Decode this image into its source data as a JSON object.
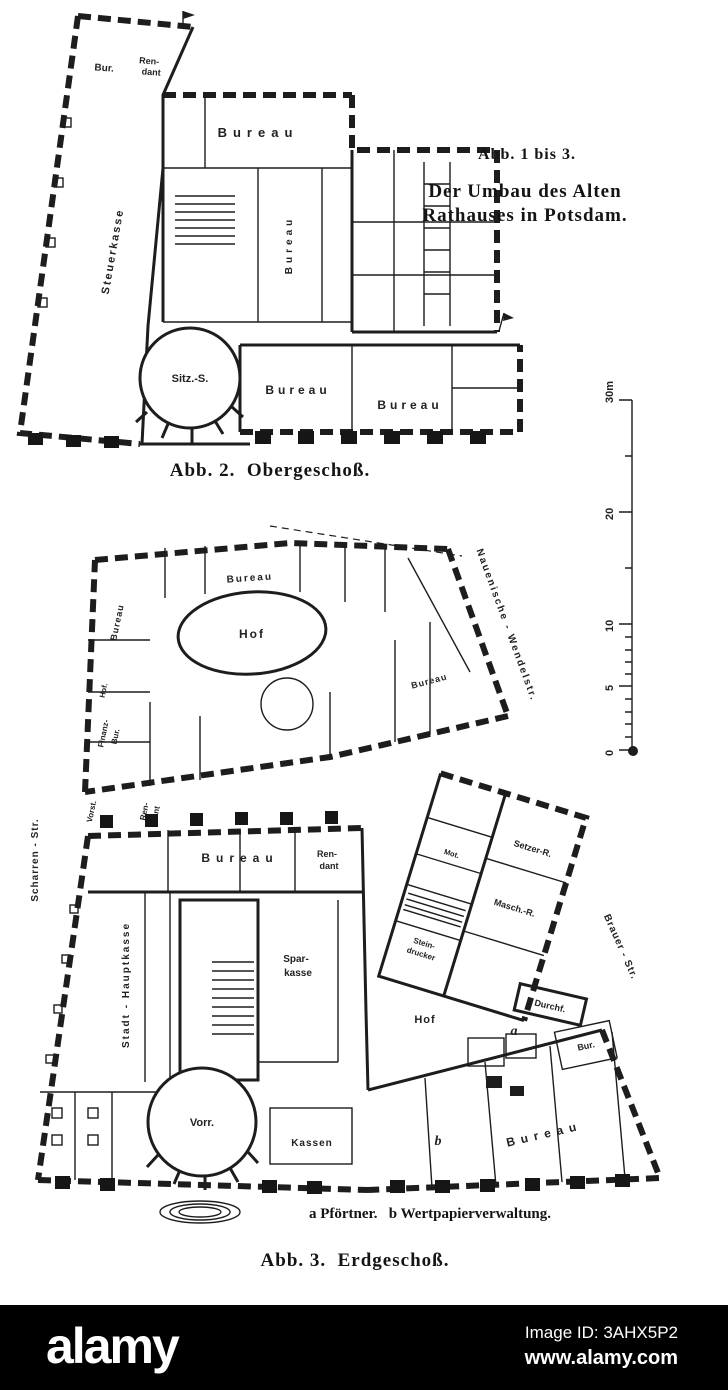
{
  "figure": {
    "title1": "Abb. 1 bis 3.",
    "title2": "Der Umbau des Alten",
    "title3": "Rathauses in Potsdam.",
    "caption_fig2": "Abb. 2.  Obergeschoß.",
    "caption_legend": "a Pförtner.   b Wertpapierverwaltung.",
    "caption_fig3": "Abb. 3.  Erdgeschoß."
  },
  "scalebar": {
    "t30": "30m",
    "t20": "20",
    "t10": "10",
    "t5": "5",
    "t0": "0"
  },
  "streets": {
    "scharren": "Scharren - Str.",
    "brauer": "Brauer - Str.",
    "wendel": "Nauenische - Wendelstr."
  },
  "upper": {
    "bur": "Bur.",
    "ren": "Ren-",
    "dant": "dant",
    "bureau_hall": "Bureau",
    "steuerkasse": "Steuerkasse",
    "bureau_vert": "Bureau",
    "sitzungssaal": "Sitz.-S.",
    "bureau_a": "Bureau",
    "bureau_b": "Bureau"
  },
  "middle": {
    "bureau_top": "Bureau",
    "bureau_left": "Bureau",
    "hof": "Hof",
    "hof_small": "Hof.",
    "finanz1": "Finanz-",
    "finanz2": "Bur.",
    "bureau_right": "Bureau",
    "vorst": "Vorst.",
    "ren": "Ren-",
    "dant": "dant"
  },
  "lower": {
    "bureau_top": "Bureau",
    "ren": "Ren-",
    "dant": "dant",
    "hauptkasse": "Stadt - Hauptkasse",
    "spar1": "Spar-",
    "spar2": "kasse",
    "hof": "Hof",
    "setzer": "Setzer-R.",
    "masch": "Masch.-R.",
    "mot": "Mot.",
    "stein1": "Stein-",
    "stein2": "drucker",
    "durchf": "Durchf.",
    "bur": "Bur.",
    "bureau_wing": "Bureau",
    "vorr": "Vorr.",
    "kassen": "Kassen",
    "marker_a": "a",
    "marker_b": "b"
  },
  "watermark": {
    "logo": "alamy",
    "image_id": "Image ID: 3AHX5P2",
    "url": "www.alamy.com",
    "bg": "#000000",
    "fg": "#ffffff"
  },
  "colors": {
    "ink": "#1d1d1d",
    "paper": "#ffffff"
  }
}
